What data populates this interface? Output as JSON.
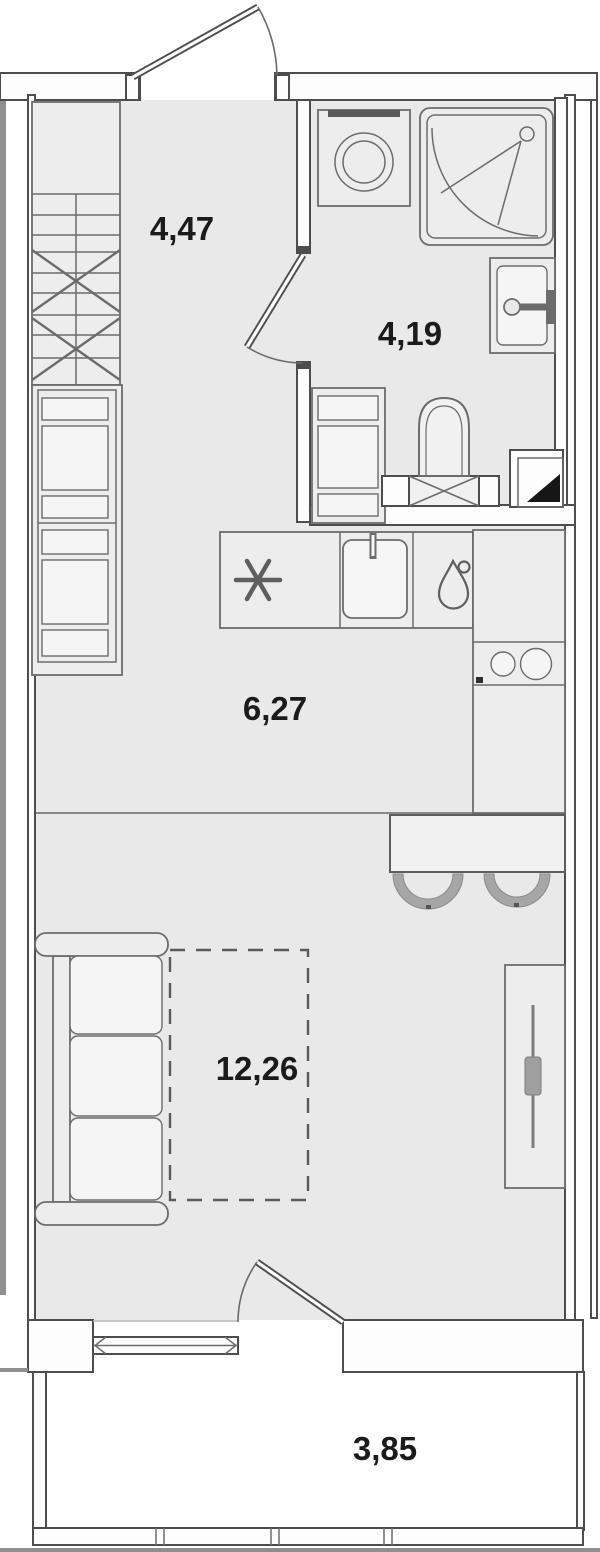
{
  "floor_plan": {
    "title": "Studio apartment floor plan",
    "units": "m2",
    "rooms": [
      {
        "name": "hallway",
        "area_label": "4,47"
      },
      {
        "name": "bathroom",
        "area_label": "4,19"
      },
      {
        "name": "kitchen",
        "area_label": "6,27"
      },
      {
        "name": "living-room",
        "area_label": "12,26"
      },
      {
        "name": "balcony",
        "area_label": "3,85"
      }
    ],
    "fixtures": [
      "entrance-door",
      "hall-shelving-rack",
      "hall-cabinet",
      "storage-cabinet",
      "washing-machine",
      "shower-cabin",
      "washbasin",
      "toilet",
      "ventilation-shaft",
      "refrigerator-snowflake-icon",
      "kitchen-sink",
      "dishwasher-drop-icon",
      "cooktop-two-burners",
      "bar-counter",
      "bar-stool",
      "bar-stool",
      "sofa",
      "bed-zone-dashed",
      "wardrobe-with-rail",
      "bathroom-door",
      "balcony-door",
      "window",
      "balcony-railing"
    ],
    "colors": {
      "floor": "#e9e9e9",
      "wall_line": "#4d4d4d",
      "furniture_line": "#6c6c6c",
      "label": "#1b1b1b",
      "stool": "#a6a6a6",
      "outer_strip": "#909090"
    }
  }
}
